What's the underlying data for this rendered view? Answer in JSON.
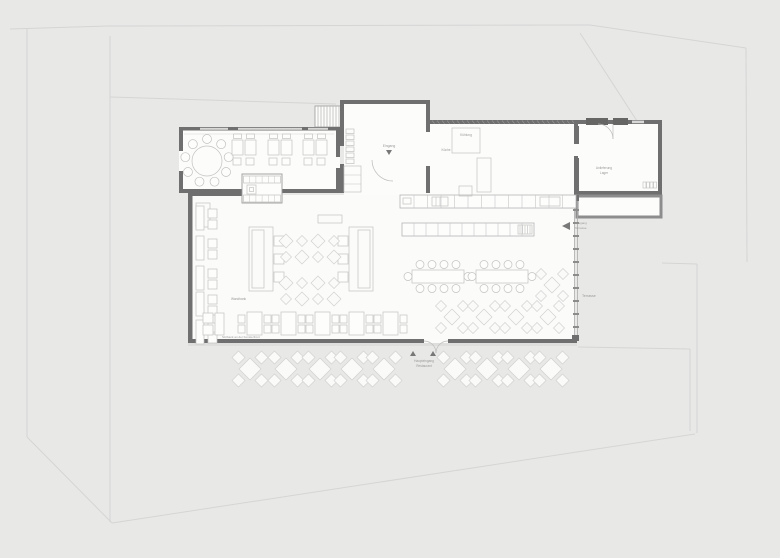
{
  "document": {
    "kind": "architectural floor plan",
    "subject": "restaurant ground floor with terrace seating"
  },
  "labels": {
    "entry_marker": "Eingang",
    "cold_room": "Kühlung",
    "kitchen": "Küche",
    "delivery_line1": "Anlieferung",
    "delivery_line2": "Lager",
    "exit_line1": "Ausgang",
    "exit_line2": "Terrasse",
    "terrace": "Terrasse",
    "bench_note": "Wandbank",
    "window_bench_note": "Sitzbank an der Fensterfront",
    "main_entrance_line1": "Haupteingang",
    "main_entrance_line2": "Restaurant"
  },
  "colors": {
    "background": "#e8e8e7",
    "site_line": "#d2d2d1",
    "wall": "#6f6f6f",
    "wall_light": "#8d8d8d",
    "room_fill": "#fcfcfb",
    "hall_fill": "#fbfbfa",
    "furniture_stroke": "#c2c2c1",
    "furniture_fill": "#fdfdfc",
    "diamond_stroke": "#d1d1d0",
    "diamond_fill": "#fafaf9",
    "glass": "#ababab",
    "text": "#9a9a9a",
    "marker": "#787878"
  }
}
